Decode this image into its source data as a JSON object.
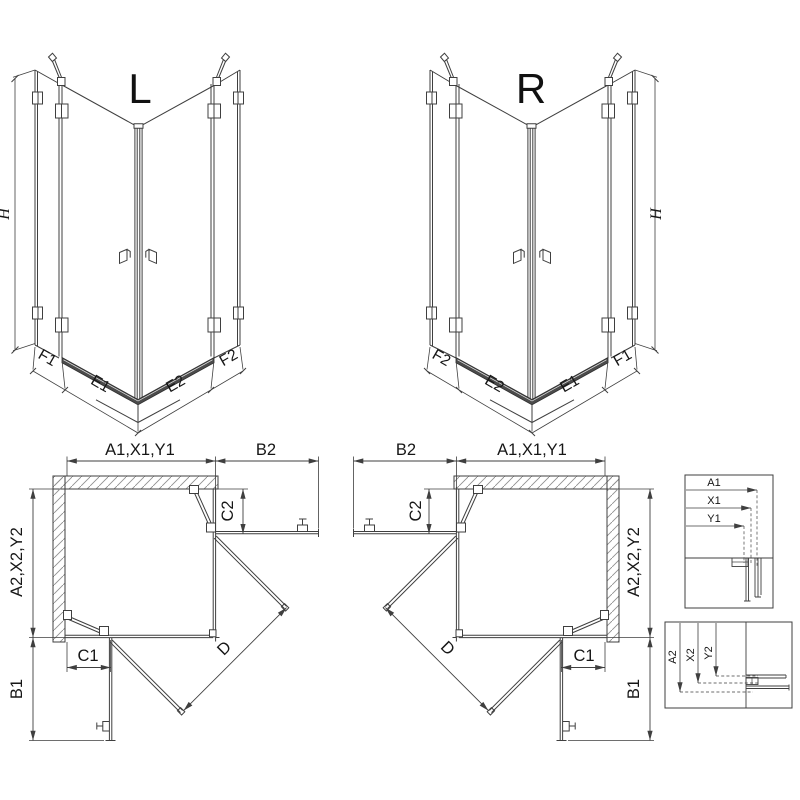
{
  "views3d": {
    "left": {
      "title": "L",
      "height": "H",
      "dims": [
        "F1",
        "E1",
        "E2",
        "F2"
      ]
    },
    "right": {
      "title": "R",
      "height": "H",
      "dims": [
        "F2",
        "E2",
        "E1",
        "F1"
      ]
    }
  },
  "plans": {
    "left": {
      "width_top": "A1,X1,Y1",
      "side_top": "B2",
      "offset_top": "C2",
      "depth": "A2,X2,Y2",
      "side": "B1",
      "offset_bottom": "C1",
      "diagonal": "D"
    },
    "right": {
      "width_top": "A1,X1,Y1",
      "side_top": "B2",
      "offset_top": "C2",
      "depth": "A2,X2,Y2",
      "side": "B1",
      "offset_bottom": "C1",
      "diagonal": "D"
    }
  },
  "details": {
    "box_width": {
      "labels": [
        "A1",
        "X1",
        "Y1"
      ]
    },
    "box_depth": {
      "labels": [
        "A2",
        "X2",
        "Y2"
      ]
    }
  },
  "colors": {
    "line": "#3f3f3f",
    "hatch": "#8f8f8f",
    "rail": "#4b4b4b",
    "text": "#161616"
  }
}
